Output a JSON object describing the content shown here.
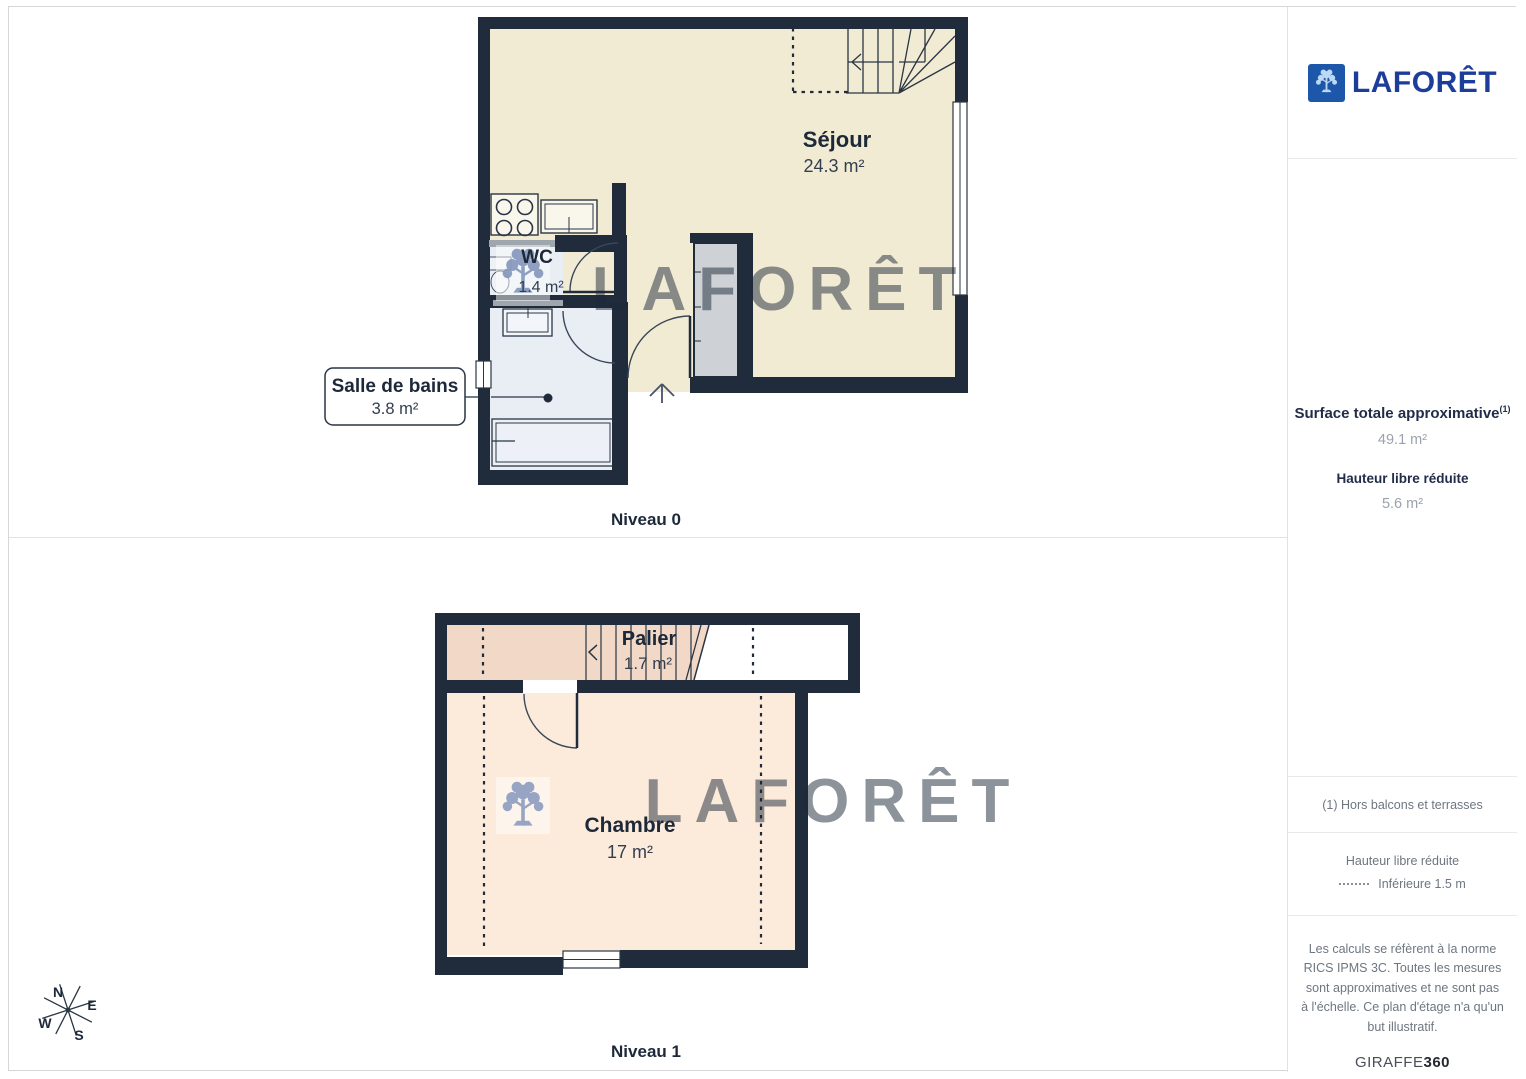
{
  "brand": {
    "name": "LAFORÊT"
  },
  "plans": [
    {
      "label": "Niveau 0",
      "rooms": [
        {
          "name": "Séjour",
          "area": "24.3 m²"
        },
        {
          "name": "WC",
          "area": "1.4 m²"
        },
        {
          "name": "Salle de bains",
          "area": "3.8 m²"
        }
      ]
    },
    {
      "label": "Niveau 1",
      "rooms": [
        {
          "name": "Palier",
          "area": "1.7 m²"
        },
        {
          "name": "Chambre",
          "area": "17 m²"
        }
      ]
    }
  ],
  "sidebar": {
    "surface_title": "Surface totale approximative",
    "surface_footnote_marker": "(1)",
    "surface_value": "49.1 m²",
    "reduced_height_title": "Hauteur libre réduite",
    "reduced_height_value": "5.6 m²",
    "footnote": "(1) Hors balcons et terrasses",
    "legend_title": "Hauteur libre réduite",
    "legend_item": "Inférieure 1.5 m",
    "disclaimer": "Les calculs se réfèrent à la norme RICS IPMS 3C. Toutes les mesures sont approximatives et ne sont pas à l'échelle. Ce plan d'étage n'a qu'un but illustratif.",
    "credit_brand": "GIRAFFE",
    "credit_suffix": "360"
  },
  "compass": {
    "north": "N",
    "east": "E",
    "south": "S",
    "west": "W"
  },
  "watermark": {
    "text": "LAFORÊT"
  },
  "colors": {
    "wall": "#202c3b",
    "sejour_floor": "#f2ebd3",
    "wet_room_floor": "#e9edf4",
    "palier_floor": "#f1d8c7",
    "chambre_floor": "#fcebdb",
    "closet_gray": "#ced2d6",
    "brand_square_blue": "#1d57a9",
    "brand_text_blue": "#1c3e9a",
    "label_navy": "#1d2939",
    "muted_gray": "#9aa2ad"
  }
}
